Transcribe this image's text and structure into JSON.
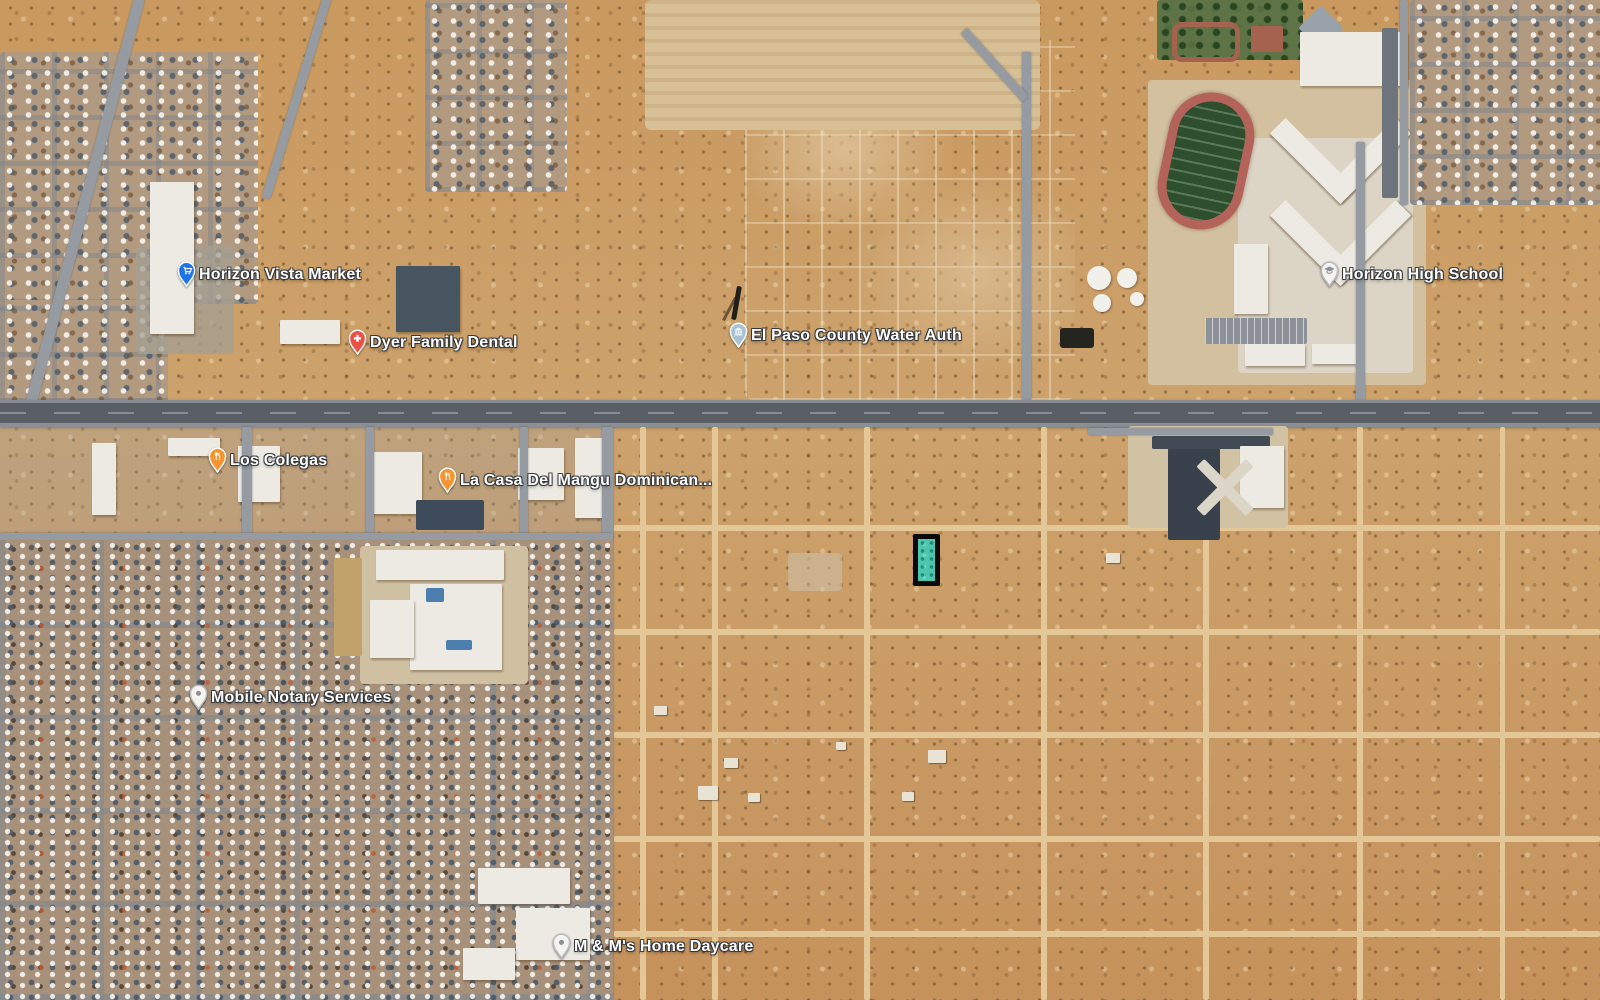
{
  "map": {
    "view_type": "satellite",
    "markers": [
      {
        "name": "horizon-vista-market",
        "label": "Horizon Vista Market",
        "glyph": "shopping-cart",
        "pin_color": "#1f73e8",
        "pin_style": "colored",
        "x": 186,
        "y": 271
      },
      {
        "name": "dyer-family-dental",
        "label": "Dyer Family Dental",
        "glyph": "medical-cross",
        "pin_color": "#ea5045",
        "pin_style": "colored",
        "x": 357,
        "y": 339
      },
      {
        "name": "el-paso-county-water-auth",
        "label": "El Paso County Water Auth",
        "glyph": "civic-building",
        "pin_color": "#a9c3d4",
        "pin_style": "colored",
        "x": 738,
        "y": 332
      },
      {
        "name": "horizon-high-school",
        "label": "Horizon High School",
        "glyph": "school",
        "pin_color": "#f5f3f0",
        "pin_style": "white",
        "x": 1329,
        "y": 271
      },
      {
        "name": "los-colegas",
        "label": "Los Colegas",
        "glyph": "restaurant",
        "pin_color": "#f59531",
        "pin_style": "colored",
        "x": 217,
        "y": 457
      },
      {
        "name": "la-casa-del-mangu",
        "label": "La Casa Del Mangu Dominican...",
        "glyph": "restaurant",
        "pin_color": "#f59531",
        "pin_style": "colored",
        "x": 447,
        "y": 477
      },
      {
        "name": "mobile-notary-services",
        "label": "Mobile Notary Services",
        "glyph": "generic-place",
        "pin_color": "#f5f3f0",
        "pin_style": "white",
        "x": 198,
        "y": 694
      },
      {
        "name": "m-and-ms-home-daycare",
        "label": "M & M's Home Daycare",
        "glyph": "generic-place",
        "pin_color": "#f5f3f0",
        "pin_style": "white",
        "x": 561,
        "y": 943
      }
    ],
    "highlighted_parcel": {
      "x": 913,
      "y": 534,
      "width": 27,
      "height": 52,
      "fill_color": "#4cc7ae",
      "outline_color": "#0a0a0a",
      "outline_width": 5
    },
    "palette": {
      "desert": "#c79a64",
      "road": "#959ba1",
      "highway": "#5a5f65",
      "dirt_road": "#e4c796",
      "field_green": "#2d4f2e",
      "track_red": "#b4635a",
      "label_text": "#ffffff"
    }
  }
}
